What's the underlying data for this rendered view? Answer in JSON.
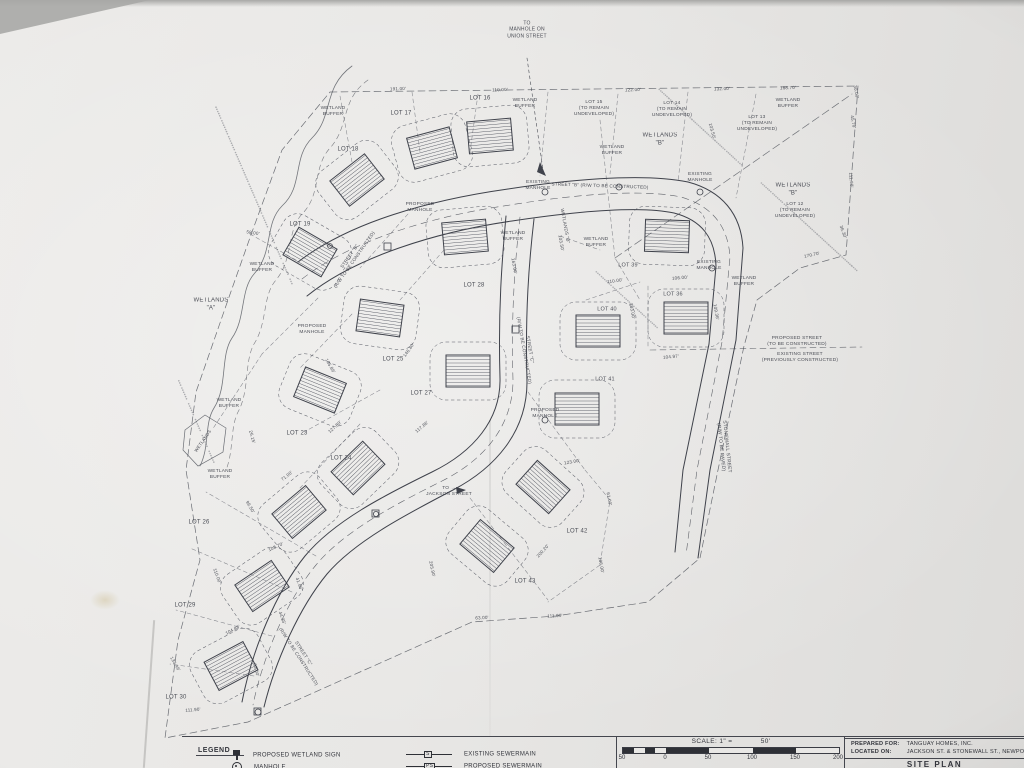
{
  "legend": {
    "heading": "LEGEND",
    "items": [
      {
        "symbol": "wetland-sign-icon",
        "label": "PROPOSED WETLAND SIGN"
      },
      {
        "symbol": "manhole-icon",
        "label": "MANHOLE"
      },
      {
        "symbol": "existing-sewermain-icon",
        "tag": "S",
        "label": "EXISTING SEWERMAIN"
      },
      {
        "symbol": "proposed-sewermain-icon",
        "tag": "PS",
        "label": "PROPOSED SEWERMAIN"
      }
    ]
  },
  "scale_bar": {
    "label": "SCALE: 1\" =",
    "value": "50'",
    "ticks": [
      "50",
      "0",
      "50",
      "100",
      "150",
      "200"
    ]
  },
  "title_block": {
    "prepared_for_label": "PREPARED FOR:",
    "prepared_for_value": "TANGUAY HOMES, INC.",
    "located_on_label": "LOCATED ON:",
    "located_on_value": "JACKSON ST. & STONEWALL ST., NEWPORT, VT",
    "sheet_title": "SITE PLAN"
  },
  "map": {
    "labels": [
      {
        "t": "TO\nMANHOLE ON\nUNION STREET",
        "x": 527,
        "y": 30,
        "r": 0,
        "s": 5
      },
      {
        "t": "LOT 17",
        "x": 401,
        "y": 114,
        "r": 0,
        "s": 6
      },
      {
        "t": "LOT 16",
        "x": 480,
        "y": 99,
        "r": 0,
        "s": 6
      },
      {
        "t": "LOT 18",
        "x": 348,
        "y": 150,
        "r": 0,
        "s": 6
      },
      {
        "t": "LOT 19",
        "x": 300,
        "y": 225,
        "r": 0,
        "s": 6
      },
      {
        "t": "LOT 15\n(TO REMAIN\nUNDEVELOPED)",
        "x": 594,
        "y": 109,
        "r": 0,
        "s": 4.8
      },
      {
        "t": "LOT 14\n(TO REMAIN\nUNDEVELOPED)",
        "x": 672,
        "y": 110,
        "r": 0,
        "s": 4.8
      },
      {
        "t": "LOT 13\n(TO REMAIN\nUNDEVELOPED)",
        "x": 757,
        "y": 124,
        "r": 0,
        "s": 4.8
      },
      {
        "t": "LOT 12\n(TO REMAIN\nUNDEVELOPED)",
        "x": 795,
        "y": 211,
        "r": 0,
        "s": 4.8
      },
      {
        "t": "LOT 28",
        "x": 474,
        "y": 286,
        "r": 0,
        "s": 6
      },
      {
        "t": "LOT 39",
        "x": 628,
        "y": 266,
        "r": 0,
        "s": 5.5
      },
      {
        "t": "LOT 40",
        "x": 607,
        "y": 310,
        "r": 0,
        "s": 5.5
      },
      {
        "t": "LOT 36",
        "x": 673,
        "y": 295,
        "r": 0,
        "s": 5.5
      },
      {
        "t": "LOT 41",
        "x": 605,
        "y": 380,
        "r": 0,
        "s": 5.5
      },
      {
        "t": "LOT 25",
        "x": 393,
        "y": 360,
        "r": 0,
        "s": 6
      },
      {
        "t": "LOT 27",
        "x": 421,
        "y": 394,
        "r": 0,
        "s": 6
      },
      {
        "t": "LOT 23",
        "x": 297,
        "y": 434,
        "r": 0,
        "s": 6
      },
      {
        "t": "LOT 24",
        "x": 341,
        "y": 459,
        "r": 0,
        "s": 6
      },
      {
        "t": "LOT 26",
        "x": 199,
        "y": 523,
        "r": 0,
        "s": 6
      },
      {
        "t": "LOT 29",
        "x": 185,
        "y": 606,
        "r": 0,
        "s": 6
      },
      {
        "t": "LOT 30",
        "x": 176,
        "y": 698,
        "r": 0,
        "s": 6
      },
      {
        "t": "LOT 42",
        "x": 577,
        "y": 532,
        "r": 0,
        "s": 6
      },
      {
        "t": "LOT 43",
        "x": 525,
        "y": 582,
        "r": 0,
        "s": 6
      },
      {
        "t": "WETLANDS\n\"B\"",
        "x": 660,
        "y": 140,
        "r": 0,
        "s": 6
      },
      {
        "t": "WETLANDS\n\"B\"",
        "x": 793,
        "y": 190,
        "r": 0,
        "s": 6
      },
      {
        "t": "WETLANDS\n\"A\"",
        "x": 211,
        "y": 305,
        "r": 0,
        "s": 6
      },
      {
        "t": "WETLANDS \"B\"",
        "x": 565,
        "y": 226,
        "r": 80,
        "s": 4.6
      },
      {
        "t": "WETLANDS",
        "x": 203,
        "y": 441,
        "r": -55,
        "s": 4.4
      },
      {
        "t": "WETLAND\nBUFFER",
        "x": 333,
        "y": 112,
        "r": 0,
        "s": 4.8
      },
      {
        "t": "WETLAND\nBUFFER",
        "x": 525,
        "y": 104,
        "r": 0,
        "s": 4.8
      },
      {
        "t": "WETLAND\nBUFFER",
        "x": 788,
        "y": 104,
        "r": 0,
        "s": 4.8
      },
      {
        "t": "WETLAND\nBUFFER",
        "x": 612,
        "y": 151,
        "r": 0,
        "s": 4.8
      },
      {
        "t": "WETLAND\nBUFFER",
        "x": 262,
        "y": 268,
        "r": 0,
        "s": 4.8
      },
      {
        "t": "WETLAND\nBUFFER",
        "x": 513,
        "y": 237,
        "r": 0,
        "s": 4.8
      },
      {
        "t": "WETLAND\nBUFFER",
        "x": 596,
        "y": 243,
        "r": 0,
        "s": 4.8
      },
      {
        "t": "WETLAND\nBUFFER",
        "x": 744,
        "y": 282,
        "r": 0,
        "s": 4.8
      },
      {
        "t": "WETLAND\nBUFFER",
        "x": 229,
        "y": 404,
        "r": 0,
        "s": 4.8
      },
      {
        "t": "WETLAND\nBUFFER",
        "x": 220,
        "y": 475,
        "r": 0,
        "s": 4.8
      },
      {
        "t": "EXISTING\nMANHOLE",
        "x": 538,
        "y": 186,
        "r": 0,
        "s": 4.8
      },
      {
        "t": "EXISTING\nMANHOLE",
        "x": 700,
        "y": 178,
        "r": 0,
        "s": 4.8
      },
      {
        "t": "EXISTING\nMANHOLE",
        "x": 709,
        "y": 266,
        "r": 0,
        "s": 4.8
      },
      {
        "t": "PROPOSED\nMANHOLE",
        "x": 420,
        "y": 208,
        "r": 0,
        "s": 4.8
      },
      {
        "t": "PROPOSED\nMANHOLE",
        "x": 312,
        "y": 330,
        "r": 0,
        "s": 4.8
      },
      {
        "t": "PROPOSED\nMANHOLE",
        "x": 545,
        "y": 414,
        "r": 0,
        "s": 4.8
      },
      {
        "t": "STREET \"B\"\n(R/W TO BE CONSTRUCTED)",
        "x": 352,
        "y": 258,
        "r": -55,
        "s": 4.6
      },
      {
        "t": "STREET \"B\" (R/W TO BE CONSTRUCTED)",
        "x": 600,
        "y": 186,
        "r": 2,
        "s": 4.6
      },
      {
        "t": "STREET \"C\"\n(R/W TO BE CONSTRUCTED)",
        "x": 527,
        "y": 350,
        "r": 80,
        "s": 4.6
      },
      {
        "t": "STREET \"C\"\n(R/W TO BE CONSTRUCTED)",
        "x": 301,
        "y": 655,
        "r": 57,
        "s": 4.6
      },
      {
        "t": "STONEWALL STREET\n(R/W TO BE PAVED)",
        "x": 723,
        "y": 447,
        "r": 84,
        "s": 4.8
      },
      {
        "t": "PROPOSED STREET\n(TO BE CONSTRUCTED)",
        "x": 797,
        "y": 342,
        "r": 0,
        "s": 4.8
      },
      {
        "t": "EXISTING STREET\n(PREVIOUSLY CONSTRUCTED)",
        "x": 800,
        "y": 358,
        "r": 0,
        "s": 4.8
      },
      {
        "t": "TO →\nJACKSON STREET",
        "x": 449,
        "y": 492,
        "r": 0,
        "s": 4.8
      },
      {
        "t": "191.00'",
        "x": 398,
        "y": 89,
        "r": -2,
        "s": 4.5
      },
      {
        "t": "110.00'",
        "x": 500,
        "y": 90,
        "r": -2,
        "s": 4.5
      },
      {
        "t": "122.00'",
        "x": 633,
        "y": 90,
        "r": -2,
        "s": 4.5
      },
      {
        "t": "132.00'",
        "x": 722,
        "y": 89,
        "r": -2,
        "s": 4.5
      },
      {
        "t": "188.70'",
        "x": 788,
        "y": 88,
        "r": -2,
        "s": 4.5
      },
      {
        "t": "30.00'",
        "x": 856,
        "y": 92,
        "r": 80,
        "s": 4.5
      },
      {
        "t": "45.70'",
        "x": 853,
        "y": 122,
        "r": 80,
        "s": 4.5
      },
      {
        "t": "111.90'",
        "x": 851,
        "y": 180,
        "r": 85,
        "s": 4.5
      },
      {
        "t": "36.30'",
        "x": 843,
        "y": 232,
        "r": 70,
        "s": 4.5
      },
      {
        "t": "170.70'",
        "x": 812,
        "y": 255,
        "r": -12,
        "s": 4.5
      },
      {
        "t": "103.50'",
        "x": 712,
        "y": 131,
        "r": 75,
        "s": 4.5
      },
      {
        "t": "163.00'",
        "x": 514,
        "y": 266,
        "r": 80,
        "s": 4.5
      },
      {
        "t": "103.50'",
        "x": 561,
        "y": 243,
        "r": 80,
        "s": 4.5
      },
      {
        "t": "110.00'",
        "x": 615,
        "y": 281,
        "r": -8,
        "s": 4.5
      },
      {
        "t": "103.00'",
        "x": 632,
        "y": 311,
        "r": 80,
        "s": 4.5
      },
      {
        "t": "106.00'",
        "x": 680,
        "y": 278,
        "r": -5,
        "s": 4.5
      },
      {
        "t": "104.97'",
        "x": 671,
        "y": 357,
        "r": -5,
        "s": 4.5
      },
      {
        "t": "109.36'",
        "x": 716,
        "y": 312,
        "r": 80,
        "s": 4.5
      },
      {
        "t": "146.80'",
        "x": 409,
        "y": 350,
        "r": -55,
        "s": 4.5
      },
      {
        "t": "105.86'",
        "x": 330,
        "y": 366,
        "r": 60,
        "s": 4.5
      },
      {
        "t": "117.86'",
        "x": 422,
        "y": 427,
        "r": -40,
        "s": 4.5
      },
      {
        "t": "127.80'",
        "x": 335,
        "y": 427,
        "r": -42,
        "s": 4.5
      },
      {
        "t": "108.70'",
        "x": 276,
        "y": 547,
        "r": -25,
        "s": 4.5
      },
      {
        "t": "99.50'",
        "x": 250,
        "y": 507,
        "r": 60,
        "s": 4.5
      },
      {
        "t": "110.00'",
        "x": 217,
        "y": 576,
        "r": 70,
        "s": 4.5
      },
      {
        "t": "104.88'",
        "x": 233,
        "y": 630,
        "r": -28,
        "s": 4.5
      },
      {
        "t": "133.46'",
        "x": 175,
        "y": 664,
        "r": 60,
        "s": 4.5
      },
      {
        "t": "93.00'",
        "x": 256,
        "y": 670,
        "r": 75,
        "s": 4.5
      },
      {
        "t": "111.90'",
        "x": 193,
        "y": 710,
        "r": -5,
        "s": 4.5
      },
      {
        "t": "44.35'",
        "x": 282,
        "y": 618,
        "r": 70,
        "s": 4.5
      },
      {
        "t": "41.86'",
        "x": 299,
        "y": 584,
        "r": 70,
        "s": 4.5
      },
      {
        "t": "123.00'",
        "x": 572,
        "y": 462,
        "r": -10,
        "s": 4.5
      },
      {
        "t": "61.00'",
        "x": 609,
        "y": 499,
        "r": 80,
        "s": 4.5
      },
      {
        "t": "106.00'",
        "x": 601,
        "y": 565,
        "r": 80,
        "s": 4.5
      },
      {
        "t": "200.20'",
        "x": 543,
        "y": 551,
        "r": -48,
        "s": 4.5
      },
      {
        "t": "111.99'",
        "x": 555,
        "y": 616,
        "r": -3,
        "s": 4.5
      },
      {
        "t": "63.00'",
        "x": 482,
        "y": 618,
        "r": -3,
        "s": 4.5
      },
      {
        "t": "205.90'",
        "x": 432,
        "y": 569,
        "r": 78,
        "s": 4.5
      },
      {
        "t": "26.15'",
        "x": 252,
        "y": 437,
        "r": 75,
        "s": 4.5
      },
      {
        "t": "71.00'",
        "x": 287,
        "y": 476,
        "r": -38,
        "s": 4.5
      },
      {
        "t": "58.00'",
        "x": 253,
        "y": 233,
        "r": 8,
        "s": 4.5
      }
    ]
  }
}
